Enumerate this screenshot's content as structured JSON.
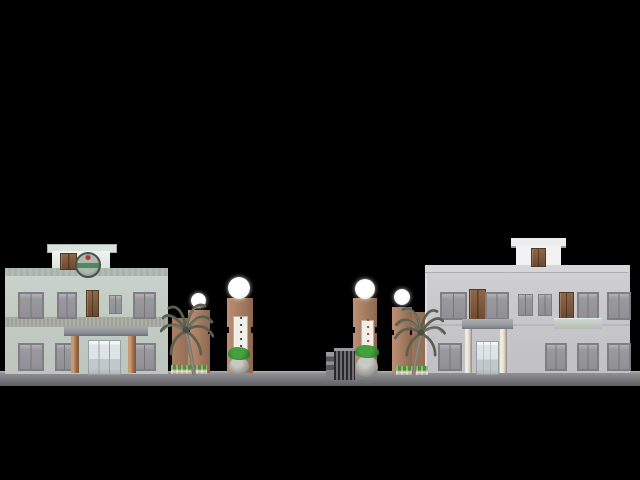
{
  "scene": {
    "description": "3D architectural elevation render: two buildings flanking an entrance gate with lamp pillars, palm trees and planters on black background",
    "canvas": {
      "width": 640,
      "height": 480
    },
    "rects": [
      {
        "name": "ground-strip",
        "cls": "ground",
        "x": 0,
        "y": 371,
        "w": 640,
        "h": 15
      },
      {
        "name": "left-building-wall",
        "cls": "wall-left",
        "x": 5,
        "y": 268,
        "w": 163,
        "h": 105
      },
      {
        "name": "left-building-parapet-band",
        "cls": "band-top-left",
        "x": 5,
        "y": 268,
        "w": 163,
        "h": 8
      },
      {
        "name": "left-building-string-course",
        "cls": "course-left",
        "x": 5,
        "y": 317,
        "w": 163,
        "h": 10
      },
      {
        "name": "left-penthouse-roof-slab",
        "cls": "slab-left",
        "x": 47,
        "y": 244,
        "w": 68,
        "h": 7
      },
      {
        "name": "left-penthouse",
        "cls": "penthouse-left",
        "x": 52,
        "y": 251,
        "w": 58,
        "h": 17
      },
      {
        "name": "left-penthouse-door",
        "cls": "door-brown",
        "x": 60,
        "y": 253,
        "w": 15,
        "h": 15
      },
      {
        "name": "rooftop-emblem",
        "cls": "emblem",
        "x": 75,
        "y": 252,
        "w": 22,
        "h": 22
      },
      {
        "name": "left-window-upper-1",
        "cls": "win",
        "x": 18,
        "y": 292,
        "w": 22,
        "h": 23
      },
      {
        "name": "left-window-upper-2",
        "cls": "win",
        "x": 57,
        "y": 292,
        "w": 16,
        "h": 23
      },
      {
        "name": "left-door-upper",
        "cls": "door-brown",
        "x": 86,
        "y": 290,
        "w": 11,
        "h": 25
      },
      {
        "name": "left-window-upper-3",
        "cls": "win-sm",
        "x": 109,
        "y": 295,
        "w": 11,
        "h": 17
      },
      {
        "name": "left-window-upper-4",
        "cls": "win",
        "x": 133,
        "y": 292,
        "w": 19,
        "h": 23
      },
      {
        "name": "left-window-lower-1",
        "cls": "win",
        "x": 18,
        "y": 343,
        "w": 22,
        "h": 24
      },
      {
        "name": "left-window-lower-2",
        "cls": "win",
        "x": 55,
        "y": 343,
        "w": 15,
        "h": 24
      },
      {
        "name": "left-window-lower-3",
        "cls": "win",
        "x": 133,
        "y": 343,
        "w": 19,
        "h": 24
      },
      {
        "name": "left-portico-canopy",
        "cls": "canopy",
        "x": 64,
        "y": 327,
        "w": 84,
        "h": 9
      },
      {
        "name": "left-portico-column-a",
        "cls": "col-brown",
        "x": 71,
        "y": 336,
        "w": 8,
        "h": 37
      },
      {
        "name": "left-portico-column-b",
        "cls": "col-brown",
        "x": 128,
        "y": 336,
        "w": 8,
        "h": 37
      },
      {
        "name": "left-entrance-glass-door",
        "cls": "glass",
        "x": 88,
        "y": 340,
        "w": 31,
        "h": 33
      },
      {
        "name": "gate-left-wall",
        "cls": "pillar-wall",
        "x": 172,
        "y": 318,
        "w": 18,
        "h": 55
      },
      {
        "name": "gate-left-short-pillar",
        "cls": "pillar",
        "x": 188,
        "y": 310,
        "w": 22,
        "h": 63
      },
      {
        "name": "gate-left-tall-pillar",
        "cls": "pillar",
        "x": 227,
        "y": 298,
        "w": 26,
        "h": 75
      },
      {
        "name": "pillar-notch-a",
        "cls": "notch",
        "x": 188,
        "y": 329,
        "w": 2,
        "h": 5
      },
      {
        "name": "pillar-notch-b",
        "cls": "notch",
        "x": 208,
        "y": 329,
        "w": 2,
        "h": 5
      },
      {
        "name": "pillar-notch-c",
        "cls": "notch",
        "x": 227,
        "y": 327,
        "w": 2,
        "h": 6
      },
      {
        "name": "pillar-notch-d",
        "cls": "notch",
        "x": 251,
        "y": 327,
        "w": 2,
        "h": 6
      },
      {
        "name": "gate-left-short-lamp",
        "cls": "lamp",
        "x": 191,
        "y": 293,
        "w": 15,
        "h": 15
      },
      {
        "name": "gate-left-tall-lamp",
        "cls": "lamp",
        "x": 228,
        "y": 277,
        "w": 22,
        "h": 22
      },
      {
        "name": "gate-right-wall",
        "cls": "pillar-wall",
        "x": 393,
        "y": 312,
        "w": 32,
        "h": 61
      },
      {
        "name": "gate-right-tall-pillar",
        "cls": "pillar",
        "x": 353,
        "y": 298,
        "w": 24,
        "h": 75
      },
      {
        "name": "gate-right-short-pillar",
        "cls": "pillar",
        "x": 392,
        "y": 307,
        "w": 20,
        "h": 66
      },
      {
        "name": "pillar-notch-e",
        "cls": "notch",
        "x": 353,
        "y": 327,
        "w": 2,
        "h": 6
      },
      {
        "name": "pillar-notch-f",
        "cls": "notch",
        "x": 375,
        "y": 327,
        "w": 2,
        "h": 6
      },
      {
        "name": "pillar-notch-g",
        "cls": "notch",
        "x": 392,
        "y": 330,
        "w": 2,
        "h": 5
      },
      {
        "name": "pillar-notch-h",
        "cls": "notch",
        "x": 410,
        "y": 330,
        "w": 2,
        "h": 5
      },
      {
        "name": "gate-right-tall-lamp",
        "cls": "lamp",
        "x": 355,
        "y": 279,
        "w": 20,
        "h": 20
      },
      {
        "name": "gate-right-short-lamp",
        "cls": "lamp",
        "x": 394,
        "y": 289,
        "w": 16,
        "h": 16
      },
      {
        "name": "gate-barrier-control-post",
        "cls": "gate-box",
        "x": 326,
        "y": 352,
        "w": 8,
        "h": 25
      },
      {
        "name": "gate-sliding-barrier",
        "cls": "gate-bars",
        "x": 334,
        "y": 348,
        "w": 21,
        "h": 29
      },
      {
        "name": "right-building-wall",
        "cls": "wall-right",
        "x": 425,
        "y": 265,
        "w": 203,
        "h": 108
      },
      {
        "name": "right-building-roof-band",
        "cls": "band-top-right",
        "x": 425,
        "y": 265,
        "w": 203,
        "h": 7
      },
      {
        "name": "right-penthouse-roof-slab",
        "cls": "slab-right",
        "x": 511,
        "y": 238,
        "w": 55,
        "h": 8
      },
      {
        "name": "right-penthouse",
        "cls": "penthouse-right",
        "x": 516,
        "y": 246,
        "w": 45,
        "h": 19
      },
      {
        "name": "right-penthouse-door",
        "cls": "door-brown",
        "x": 531,
        "y": 248,
        "w": 13,
        "h": 17
      },
      {
        "name": "right-window-upper-1",
        "cls": "win",
        "x": 440,
        "y": 292,
        "w": 23,
        "h": 24
      },
      {
        "name": "right-door-upper-1",
        "cls": "door-brown",
        "x": 469,
        "y": 289,
        "w": 15,
        "h": 31
      },
      {
        "name": "right-window-upper-2",
        "cls": "win",
        "x": 485,
        "y": 292,
        "w": 20,
        "h": 24
      },
      {
        "name": "right-window-upper-3",
        "cls": "win-sm",
        "x": 518,
        "y": 294,
        "w": 13,
        "h": 20
      },
      {
        "name": "right-window-upper-4",
        "cls": "win-sm",
        "x": 538,
        "y": 294,
        "w": 12,
        "h": 20
      },
      {
        "name": "right-door-upper-2",
        "cls": "door-brown",
        "x": 559,
        "y": 292,
        "w": 13,
        "h": 26
      },
      {
        "name": "right-window-upper-5",
        "cls": "win",
        "x": 577,
        "y": 292,
        "w": 18,
        "h": 24
      },
      {
        "name": "right-window-upper-6",
        "cls": "win",
        "x": 607,
        "y": 292,
        "w": 20,
        "h": 24
      },
      {
        "name": "right-balcony-slab",
        "cls": "balcony",
        "x": 554,
        "y": 318,
        "w": 48,
        "h": 10
      },
      {
        "name": "right-window-lower-1",
        "cls": "win",
        "x": 438,
        "y": 343,
        "w": 20,
        "h": 24
      },
      {
        "name": "right-window-lower-2",
        "cls": "win",
        "x": 545,
        "y": 343,
        "w": 18,
        "h": 24
      },
      {
        "name": "right-window-lower-3",
        "cls": "win",
        "x": 577,
        "y": 343,
        "w": 18,
        "h": 24
      },
      {
        "name": "right-window-lower-4",
        "cls": "win",
        "x": 607,
        "y": 343,
        "w": 20,
        "h": 24
      },
      {
        "name": "right-portico-canopy",
        "cls": "canopy2",
        "x": 462,
        "y": 319,
        "w": 51,
        "h": 10
      },
      {
        "name": "right-portico-column-a",
        "cls": "col-cream",
        "x": 465,
        "y": 329,
        "w": 7,
        "h": 44
      },
      {
        "name": "right-portico-column-b",
        "cls": "col-cream",
        "x": 500,
        "y": 329,
        "w": 7,
        "h": 44
      },
      {
        "name": "right-entrance-glass-door",
        "cls": "glass",
        "x": 476,
        "y": 341,
        "w": 21,
        "h": 32
      },
      {
        "name": "planter-left",
        "cls": "planter",
        "x": 171,
        "y": 365,
        "w": 36,
        "h": 9
      },
      {
        "name": "planter-right",
        "cls": "planter",
        "x": 396,
        "y": 366,
        "w": 32,
        "h": 9
      },
      {
        "name": "pot-left",
        "cls": "pot",
        "x": 229,
        "y": 357,
        "w": 20,
        "h": 17
      },
      {
        "name": "plant-left",
        "cls": "plant",
        "x": 228,
        "y": 347,
        "w": 22,
        "h": 13
      },
      {
        "name": "pot-center-right",
        "cls": "pot",
        "x": 356,
        "y": 355,
        "w": 22,
        "h": 22
      },
      {
        "name": "plant-center-right",
        "cls": "plant",
        "x": 355,
        "y": 345,
        "w": 24,
        "h": 13
      }
    ]
  },
  "signs": {
    "left_glyphs": "▪▪▪▪▪▪",
    "right_glyphs": "▪▪▪▪▪▪"
  },
  "palette": {
    "background": "#000000",
    "ground": "#7a7a7e",
    "left_building_wall": "#c3cbc5",
    "right_building_wall": "#c8c8cc",
    "window_shutter": "#97979b",
    "door_brown": "#7a5539",
    "gate_pillar_brown": "#a87f64",
    "lamp_white": "#ffffff",
    "sign_white": "#f0efe8",
    "sign_text_left": "#46464a",
    "sign_text_right": "#a04a40",
    "emblem_green": "#4e8a5e",
    "emblem_red": "#b23434",
    "plant_green": "#2f8230",
    "flower_pink": "#e8caca",
    "palm_frond": "#5c5e50",
    "palm_trunk": "#7e786c"
  }
}
